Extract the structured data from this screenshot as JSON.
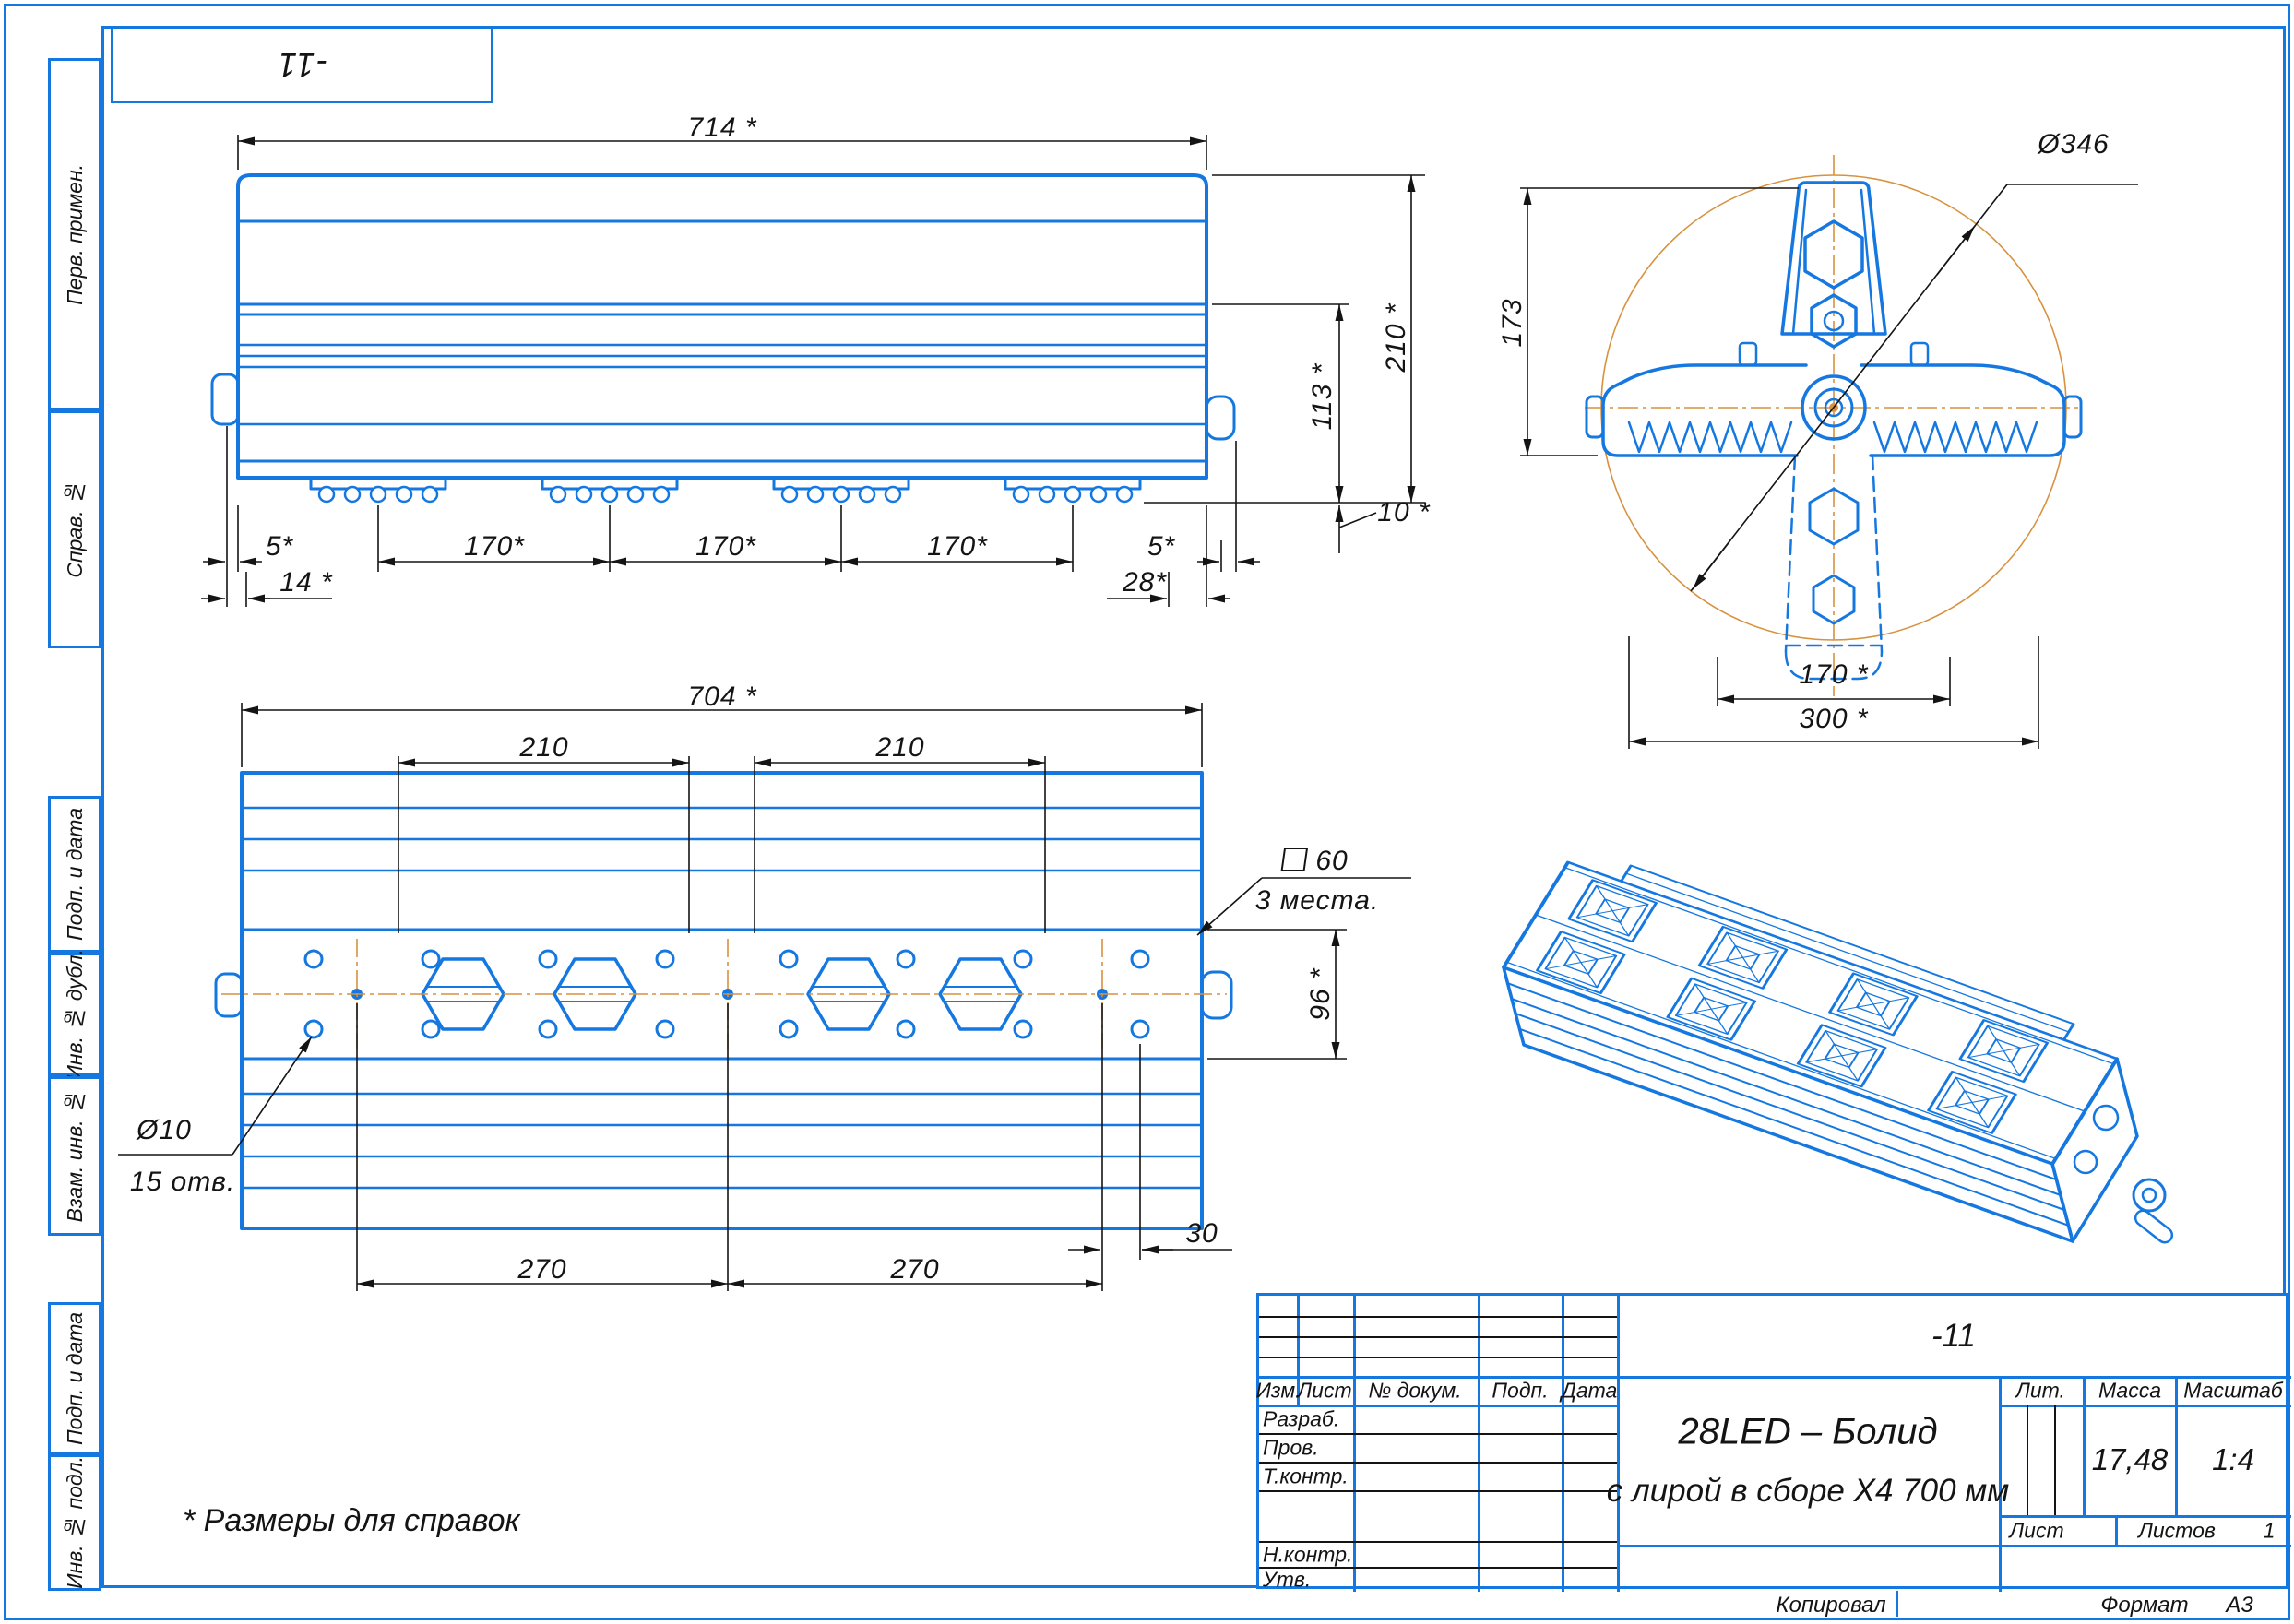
{
  "colors": {
    "cad_blue": "#1577e0",
    "dim_black": "#141414",
    "phantom_orange": "#d8913e"
  },
  "sheet": {
    "corner_designation": "-11",
    "note": "* Размеры для справок",
    "footer": {
      "copied": "Копировал",
      "format_label": "Формат",
      "format_value": "А3"
    }
  },
  "margin_labels": [
    "Перв. примен.",
    "Справ. №",
    "Подп. и дата",
    "Инв. № дубл.",
    "Взам. инв. №",
    "Подп. и дата",
    "Инв. № подл."
  ],
  "views": {
    "front": {
      "w": "714 *",
      "h": "210 *",
      "body_h": "113 *",
      "foot": "10 *",
      "e1": "5*",
      "p1": "170*",
      "p2": "170*",
      "p3": "170*",
      "e2": "5*",
      "o1": "14 *",
      "o2": "28*"
    },
    "plan": {
      "w": "704 *",
      "s1": "210",
      "s2": "210",
      "sq": "60",
      "sq_note": "3 места.",
      "h": "96 *",
      "hole_d": "Ø10",
      "hole_n": "15 отв.",
      "b1": "270",
      "b2": "270",
      "b3": "30"
    },
    "lyre": {
      "h": "173",
      "d": "Ø346",
      "p": "170 *",
      "w": "300 *"
    }
  },
  "title_block": {
    "designation": "-11",
    "name1": "28LED – Болид",
    "name2": "с лирой в сборе Х4 700 мм",
    "cols": [
      "Изм.",
      "Лист",
      "№ докум.",
      "Подп.",
      "Дата"
    ],
    "rows": [
      "Разраб.",
      "Пров.",
      "Т.контр.",
      "Н.контр.",
      "Утв."
    ],
    "lit": "Лит.",
    "mass": "Масса",
    "scale": "Масштаб",
    "mass_value": "17,48",
    "scale_value": "1:4",
    "sheet": "Лист",
    "sheets": "Листов",
    "sheets_value": "1"
  }
}
